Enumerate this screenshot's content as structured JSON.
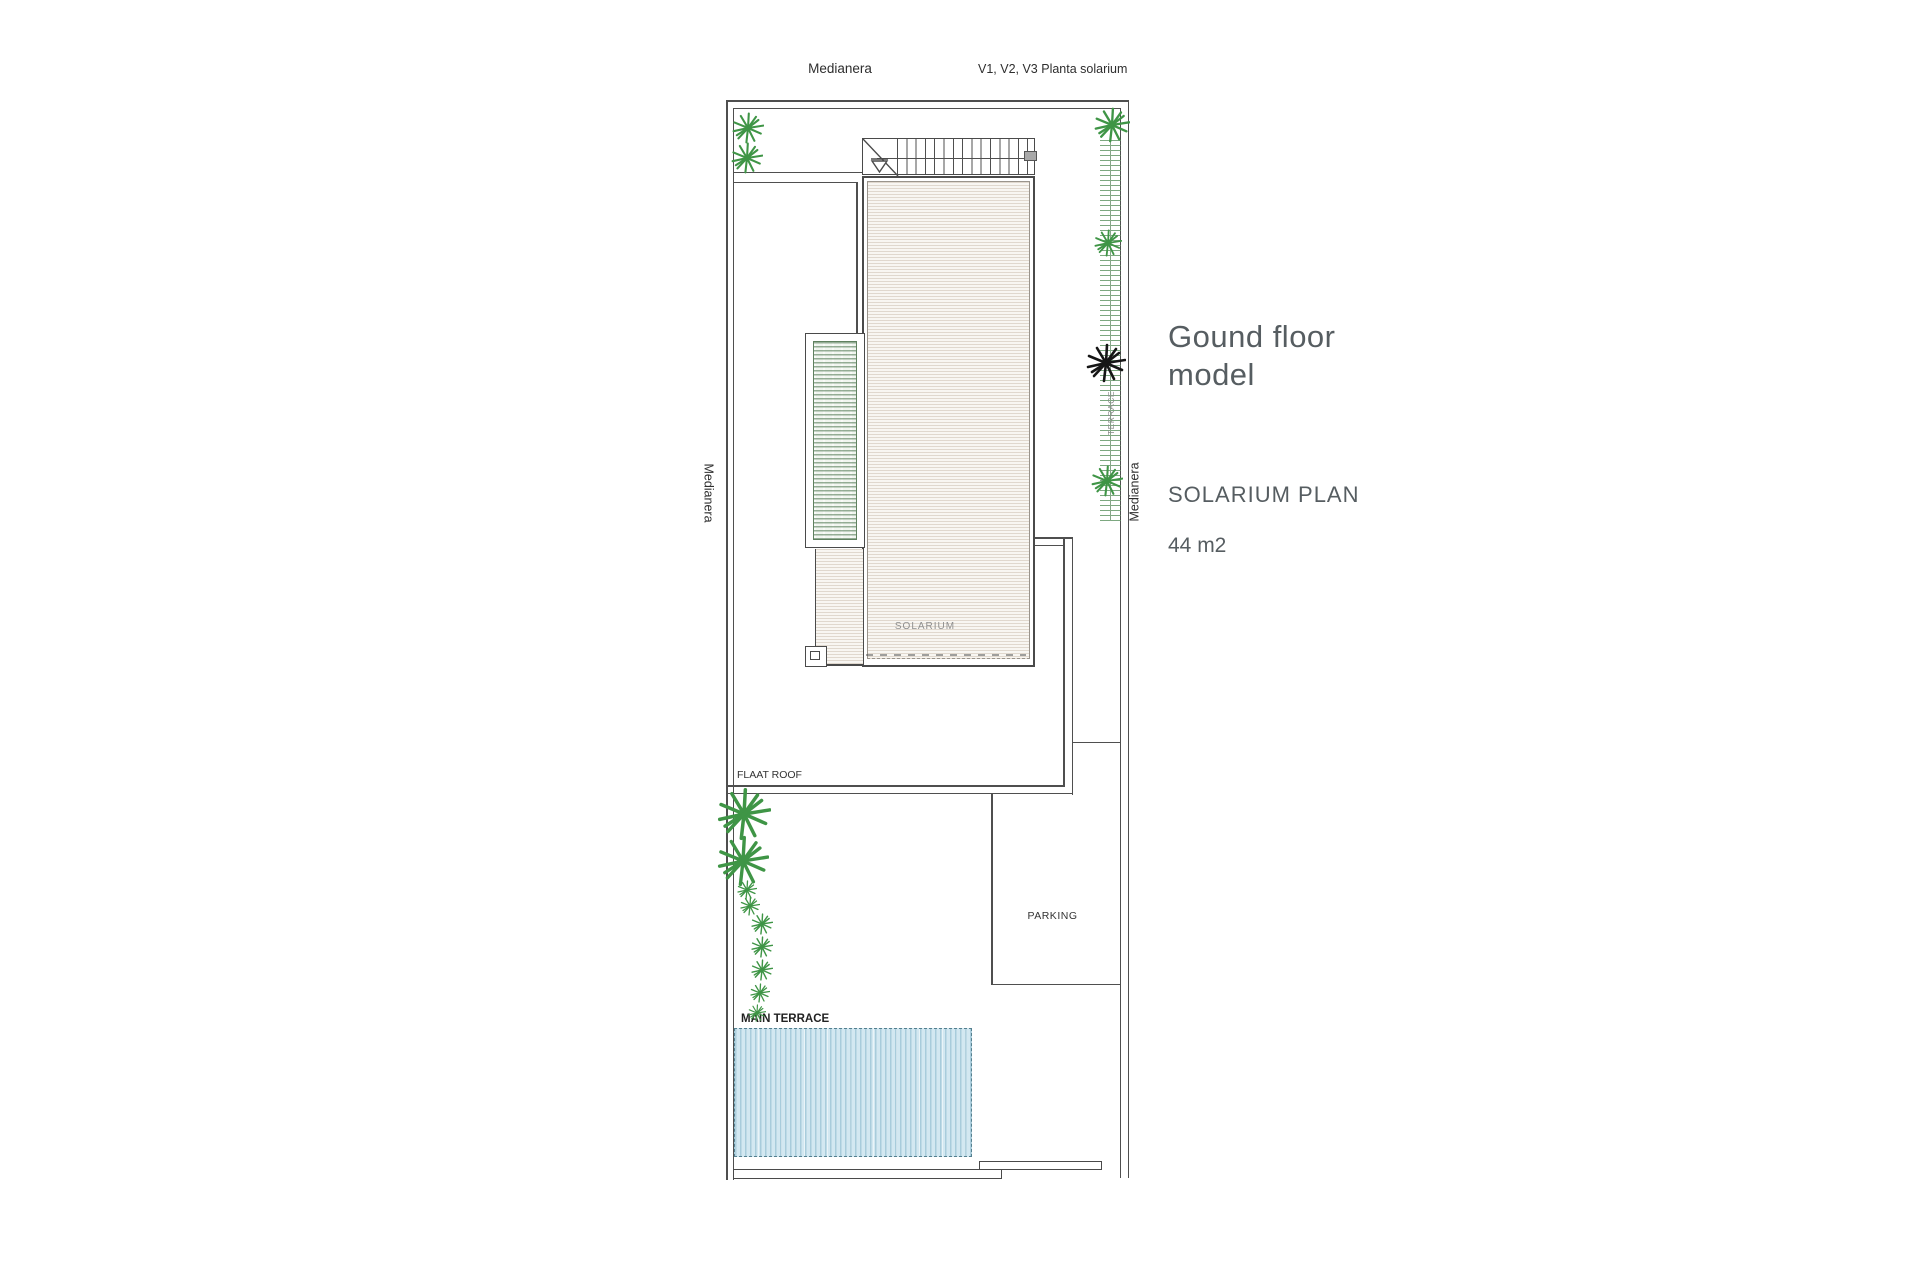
{
  "labels": {
    "top_left": "Medianera",
    "top_right": "V1, V2, V3 Planta solarium",
    "left_side": "Medianera",
    "right_side": "Medianera",
    "terrace_strip": "TERRACE",
    "solarium": "SOLARIUM",
    "flat_roof": "FLAAT ROOF",
    "parking": "PARKING",
    "main_terrace": "MAIN TERRACE"
  },
  "info_panel": {
    "title_line1": "Gound floor",
    "title_line2": "model",
    "plan_name": "SOLARIUM PLAN",
    "area": "44 m2"
  },
  "colors": {
    "wall": "#4f4f4f",
    "plant_green": "#3f9546",
    "plant_black": "#161616",
    "text_gray": "#565d61",
    "faint_text": "#8f8f8f"
  },
  "plan": {
    "plants": [
      {
        "x": 748,
        "y": 128,
        "r": 16,
        "color": "green"
      },
      {
        "x": 747,
        "y": 158,
        "r": 16,
        "color": "green"
      },
      {
        "x": 1112,
        "y": 125,
        "r": 18,
        "color": "green"
      },
      {
        "x": 1108,
        "y": 243,
        "r": 14,
        "color": "green"
      },
      {
        "x": 1106,
        "y": 363,
        "r": 20,
        "color": "black"
      },
      {
        "x": 1107,
        "y": 481,
        "r": 16,
        "color": "green"
      },
      {
        "x": 744,
        "y": 814,
        "r": 27,
        "color": "green"
      },
      {
        "x": 743,
        "y": 861,
        "r": 26,
        "color": "green"
      },
      {
        "x": 747,
        "y": 890,
        "r": 10,
        "color": "green"
      },
      {
        "x": 750,
        "y": 906,
        "r": 10,
        "color": "green"
      },
      {
        "x": 762,
        "y": 924,
        "r": 11,
        "color": "green"
      },
      {
        "x": 762,
        "y": 947,
        "r": 11,
        "color": "green"
      },
      {
        "x": 762,
        "y": 970,
        "r": 11,
        "color": "green"
      },
      {
        "x": 760,
        "y": 993,
        "r": 10,
        "color": "green"
      },
      {
        "x": 757,
        "y": 1013,
        "r": 9,
        "color": "green"
      }
    ]
  }
}
